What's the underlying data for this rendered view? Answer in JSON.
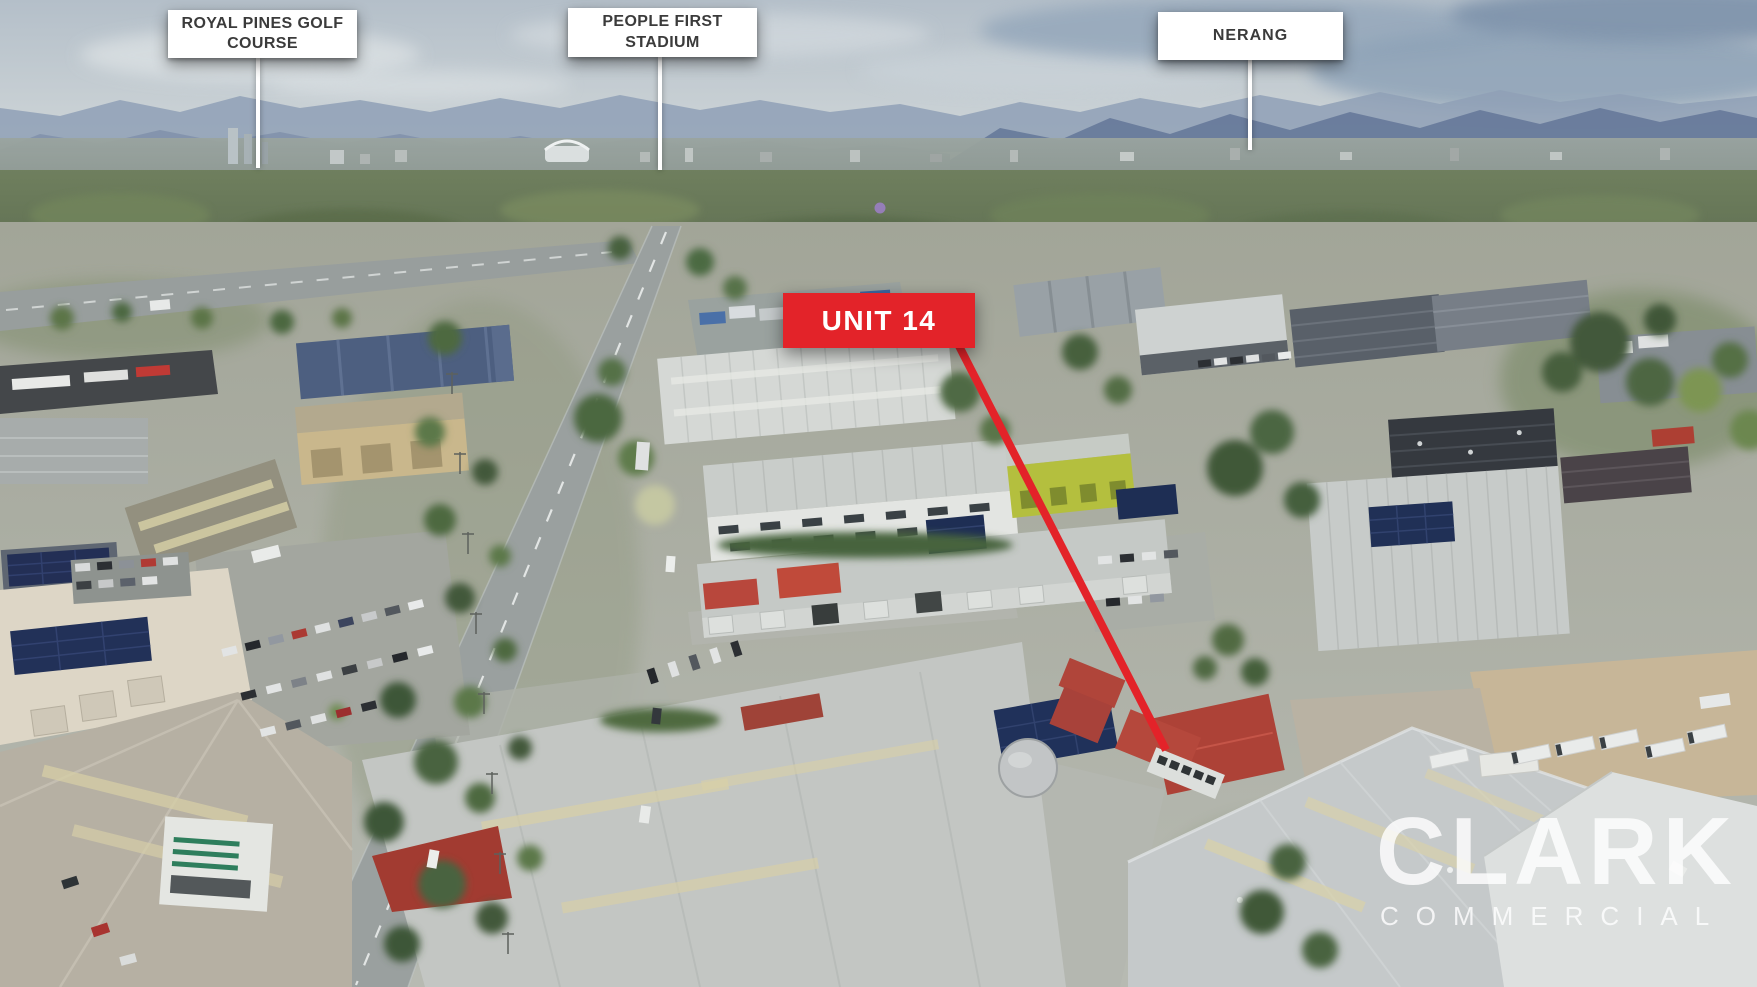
{
  "annotations": {
    "royal_pines": {
      "text": "ROYAL PINES GOLF COURSE"
    },
    "people_first": {
      "text": "PEOPLE FIRST STADIUM"
    },
    "nerang": {
      "text": "NERANG"
    },
    "unit": {
      "text": "UNIT 14"
    }
  },
  "watermark": {
    "name": "CLARK",
    "tagline": "COMMERCIAL"
  },
  "colors": {
    "label_bg": "#ffffff",
    "label_text": "#3b3b3b",
    "marker_red": "#e32329",
    "watermark_white": "rgba(255,255,255,0.8)"
  }
}
